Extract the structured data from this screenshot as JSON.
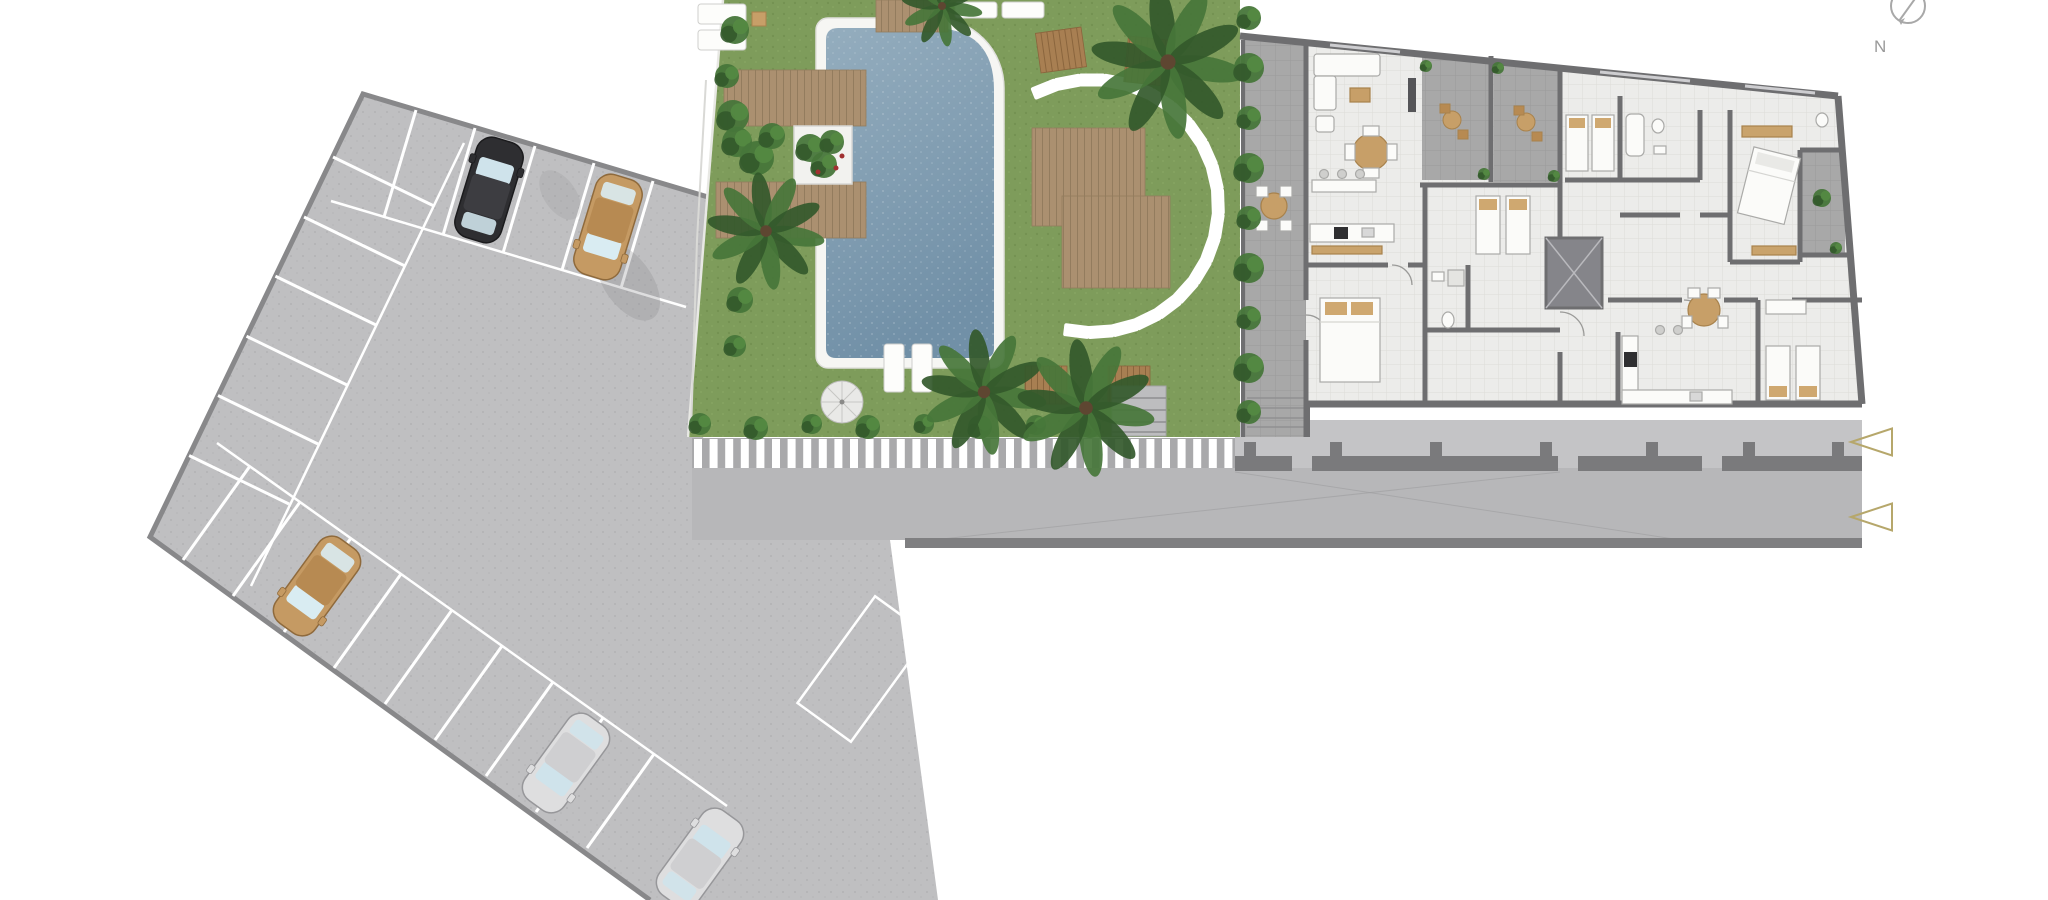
{
  "plan": {
    "kind": "residential site plan (ground floor)",
    "compass": {
      "label": "N",
      "cx": 1908,
      "cy": 6,
      "r": 17
    },
    "palette": {
      "asphalt": "#bfbfc1",
      "asphalt_dot": "#b2b2b4",
      "road": "#b7b7b9",
      "sidewalk": "#c4c4c6",
      "curb": "#7f7f81",
      "stripe_bg": "#a9a9ab",
      "stripe": "#ffffff",
      "grass": "#7e9c5b",
      "grass_dot": "#6e8c4c",
      "pool_top": "#94adbe",
      "pool_bottom": "#7190a7",
      "coping": "#f6f6f3",
      "wood": "#ab9070",
      "wood_line": "#937c5e",
      "wood_dark": "#a87f52",
      "wall": "#6e6e70",
      "floor": "#ececea",
      "tile_line": "#dddcd8",
      "terrace": "#a8a8a8",
      "boundary": "#7a7a7c",
      "stone": "#ffffff",
      "green_dark": "#33592b",
      "green_mid": "#47763a",
      "furn_white": "#fbfbf9",
      "furn_stroke": "#aaaaa8",
      "tan": "#c79f68",
      "marker": "#b6a76b",
      "compass_gray": "#a3a3a3",
      "shadow": "#8a8a8c"
    },
    "parking": {
      "outline": "363,94 718,200 703,440 692,468 692,540 890,540 938,900 650,900 150,537",
      "boundary_line": "718,200 363,94 150,537 650,900",
      "stall_lines_top": [
        [
          416,
          110,
          384,
          217
        ],
        [
          475,
          128,
          443,
          235
        ],
        [
          535,
          146,
          503,
          253
        ],
        [
          594,
          163,
          562,
          270
        ],
        [
          653,
          181,
          621,
          288
        ]
      ],
      "stall_lines_left": [
        [
          333,
          157,
          434,
          206
        ],
        [
          304,
          217,
          405,
          266
        ],
        [
          275,
          276,
          376,
          325
        ],
        [
          246,
          336,
          347,
          385
        ],
        [
          217,
          395,
          318,
          444
        ],
        [
          188,
          455,
          289,
          504
        ]
      ],
      "stall_lines_bottom": [
        [
          183,
          560,
          250,
          466
        ],
        [
          233,
          596,
          300,
          502
        ],
        [
          284,
          632,
          351,
          538
        ],
        [
          334,
          668,
          401,
          574
        ],
        [
          385,
          704,
          452,
          610
        ],
        [
          435,
          740,
          502,
          646
        ],
        [
          486,
          776,
          553,
          682
        ],
        [
          536,
          812,
          603,
          718
        ],
        [
          587,
          848,
          654,
          754
        ]
      ],
      "aisle_lines": [
        [
          331,
          201,
          686,
          307
        ],
        [
          464,
          143,
          251,
          586
        ],
        [
          217,
          443,
          727,
          806
        ]
      ],
      "reserved_area": {
        "x": 863,
        "y": 669,
        "w": 66,
        "h": 132,
        "rot": 36
      },
      "shadows": [
        [
          628,
          282,
          24,
          44,
          -35,
          0.28
        ],
        [
          560,
          195,
          16,
          28,
          -35,
          0.18
        ]
      ],
      "cars": [
        {
          "name": "car-black",
          "x": 489,
          "y": 190,
          "rot": 17,
          "body": "#2e2e31",
          "roof": "#3d3d41",
          "glass": "#cfe3eb",
          "outline": "#1b1b1d"
        },
        {
          "name": "car-tan-top",
          "x": 608,
          "y": 227,
          "rot": 197,
          "body": "#c59a63",
          "roof": "#b78a52",
          "glass": "#d9ecf2",
          "outline": "#8f6a3c"
        },
        {
          "name": "car-tan-left",
          "x": 317,
          "y": 586,
          "rot": 216,
          "body": "#c59a63",
          "roof": "#b78a52",
          "glass": "#d9ecf2",
          "outline": "#8f6a3c"
        },
        {
          "name": "car-silver-mid",
          "x": 566,
          "y": 763,
          "rot": 216,
          "body": "#dededf",
          "roof": "#cfcfd1",
          "glass": "#cfe3eb",
          "outline": "#97979a"
        },
        {
          "name": "car-silver-low",
          "x": 700,
          "y": 858,
          "rot": 36,
          "body": "#dededf",
          "roof": "#cfcfd1",
          "glass": "#cfe3eb",
          "outline": "#97979a"
        }
      ]
    },
    "crosswalk": {
      "x": 694,
      "y": 439,
      "h": 29,
      "stripe_w": 8,
      "period": 15.6,
      "count": 35
    },
    "garden": {
      "stones_circle": {
        "cx": 1092,
        "cy": 206,
        "r": 126,
        "start_deg": 112,
        "step_deg": -11,
        "count": 20,
        "w": 26,
        "h": 13
      },
      "palms": [
        {
          "x": 1168,
          "y": 62,
          "r": 76
        },
        {
          "x": 942,
          "y": 6,
          "r": 40
        },
        {
          "x": 766,
          "y": 231,
          "r": 58
        },
        {
          "x": 984,
          "y": 392,
          "r": 62
        },
        {
          "x": 1086,
          "y": 408,
          "r": 68
        }
      ],
      "bushes": [
        [
          735,
          30,
          14
        ],
        [
          727,
          76,
          12
        ],
        [
          733,
          116,
          16
        ],
        [
          740,
          300,
          13
        ],
        [
          735,
          346,
          11
        ],
        [
          737,
          142,
          15
        ],
        [
          757,
          158,
          17
        ],
        [
          772,
          136,
          13
        ],
        [
          700,
          424,
          11
        ],
        [
          756,
          428,
          12
        ],
        [
          812,
          424,
          10
        ],
        [
          868,
          427,
          12
        ],
        [
          924,
          424,
          10
        ],
        [
          980,
          427,
          12
        ],
        [
          1036,
          425,
          10
        ],
        [
          1090,
          427,
          11
        ]
      ],
      "hedge_column": {
        "x": 1249,
        "ys": [
          18,
          68,
          118,
          168,
          218,
          268,
          318,
          368,
          412
        ],
        "r": 13
      },
      "planter_plants": [
        [
          810,
          148,
          14
        ],
        [
          832,
          142,
          12
        ],
        [
          824,
          165,
          13
        ]
      ],
      "planter_flowers": [
        [
          836,
          168
        ],
        [
          818,
          172
        ],
        [
          842,
          156
        ]
      ],
      "umbrella": {
        "x": 842,
        "y": 402,
        "r": 21,
        "spokes": 8
      },
      "loungers": [
        [
          884,
          344,
          20,
          48
        ],
        [
          912,
          344,
          20,
          48
        ],
        [
          698,
          4,
          48,
          20
        ],
        [
          698,
          30,
          48,
          20
        ],
        [
          955,
          2,
          42,
          16
        ],
        [
          1002,
          2,
          42,
          16
        ]
      ],
      "wood_benches": [
        [
          1038,
          30,
          46,
          40,
          -8
        ],
        [
          1126,
          38,
          42,
          46,
          6
        ],
        [
          1025,
          366,
          42,
          38,
          0
        ],
        [
          1108,
          366,
          42,
          38,
          0
        ]
      ],
      "side_table": [
        752,
        12,
        14,
        14
      ],
      "path_line": "706,80 697,240 691,432"
    },
    "building": {
      "terrace_plants": [
        [
          1426,
          66,
          6
        ],
        [
          1484,
          174,
          6
        ],
        [
          1498,
          68,
          6
        ],
        [
          1554,
          176,
          6
        ],
        [
          1822,
          198,
          9
        ],
        [
          1836,
          248,
          6
        ]
      ],
      "boundary_segments": [
        [
          1235,
          1292
        ],
        [
          1312,
          1558
        ],
        [
          1578,
          1702
        ],
        [
          1722,
          1862
        ]
      ],
      "boundary_y": 456,
      "boundary_h": 15,
      "piers_x": [
        1250,
        1336,
        1436,
        1546,
        1652,
        1749,
        1838
      ],
      "piers_y": 442
    },
    "markers": {
      "triangles": [
        {
          "tipx": 1851,
          "tipy": 442
        },
        {
          "tipx": 1851,
          "tipy": 517
        }
      ],
      "tri_w": 41,
      "tri_h": 27
    }
  }
}
